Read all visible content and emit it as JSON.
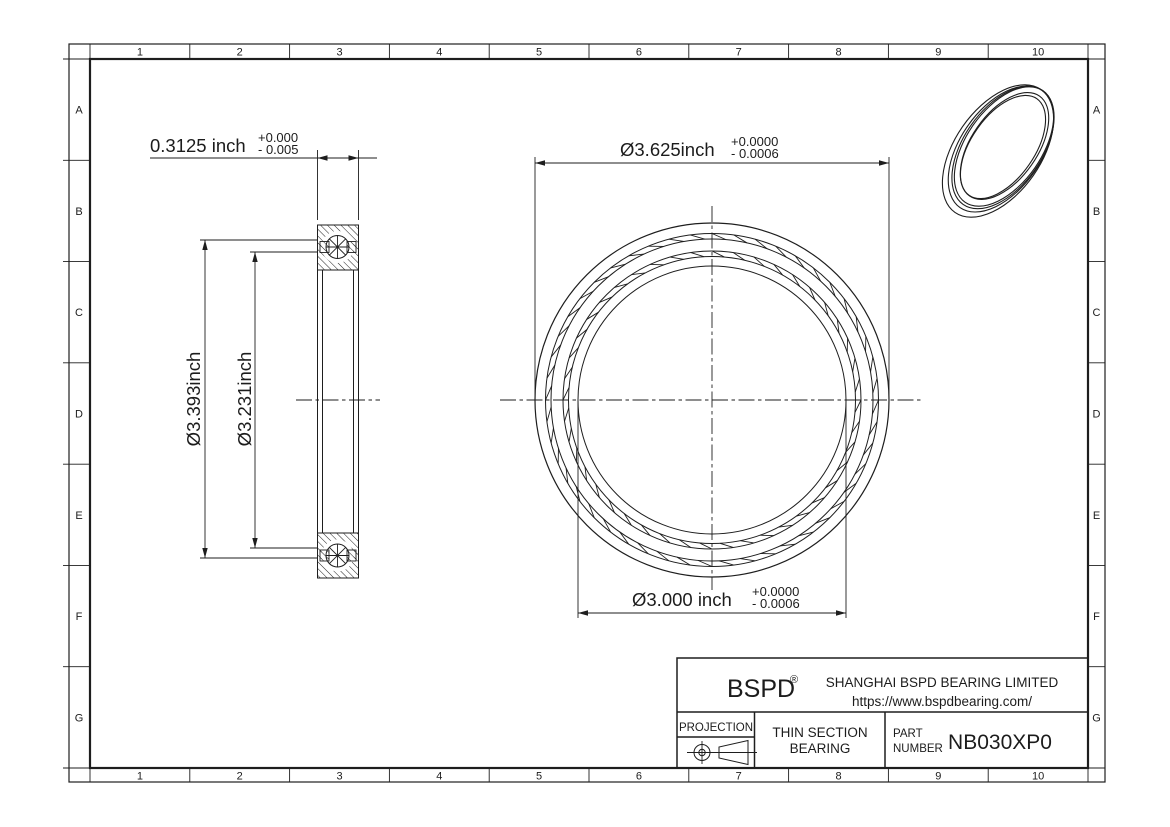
{
  "palette": {
    "line_color": "#1e1e1e",
    "background": "#ffffff"
  },
  "drawing": {
    "grid": {
      "columns": [
        "1",
        "2",
        "3",
        "4",
        "5",
        "6",
        "7",
        "8",
        "9",
        "10"
      ],
      "rows": [
        "A",
        "B",
        "C",
        "D",
        "E",
        "F",
        "G"
      ]
    },
    "dimensions": {
      "side_width": {
        "text": "0.3125 inch",
        "tol_plus": "+0.000",
        "tol_minus": "- 0.005"
      },
      "side_od": {
        "text": "Ø3.393inch"
      },
      "side_id": {
        "text": "Ø3.231inch"
      },
      "front_od": {
        "text": "Ø3.625inch",
        "tol_plus": "+0.0000",
        "tol_minus": "- 0.0006"
      },
      "front_bore": {
        "text": "Ø3.000 inch",
        "tol_plus": "+0.0000",
        "tol_minus": "- 0.0006"
      }
    },
    "title_block": {
      "brand": "BSPD",
      "brand_mark": "®",
      "company": "SHANGHAI BSPD BEARING LIMITED",
      "website": "https://www.bspdbearing.com/",
      "projection_label": "PROJECTION",
      "product_line1": "THIN SECTION",
      "product_line2": "BEARING",
      "part_label_line1": "PART",
      "part_label_line2": "NUMBER",
      "part_number": "NB030XP0"
    }
  }
}
